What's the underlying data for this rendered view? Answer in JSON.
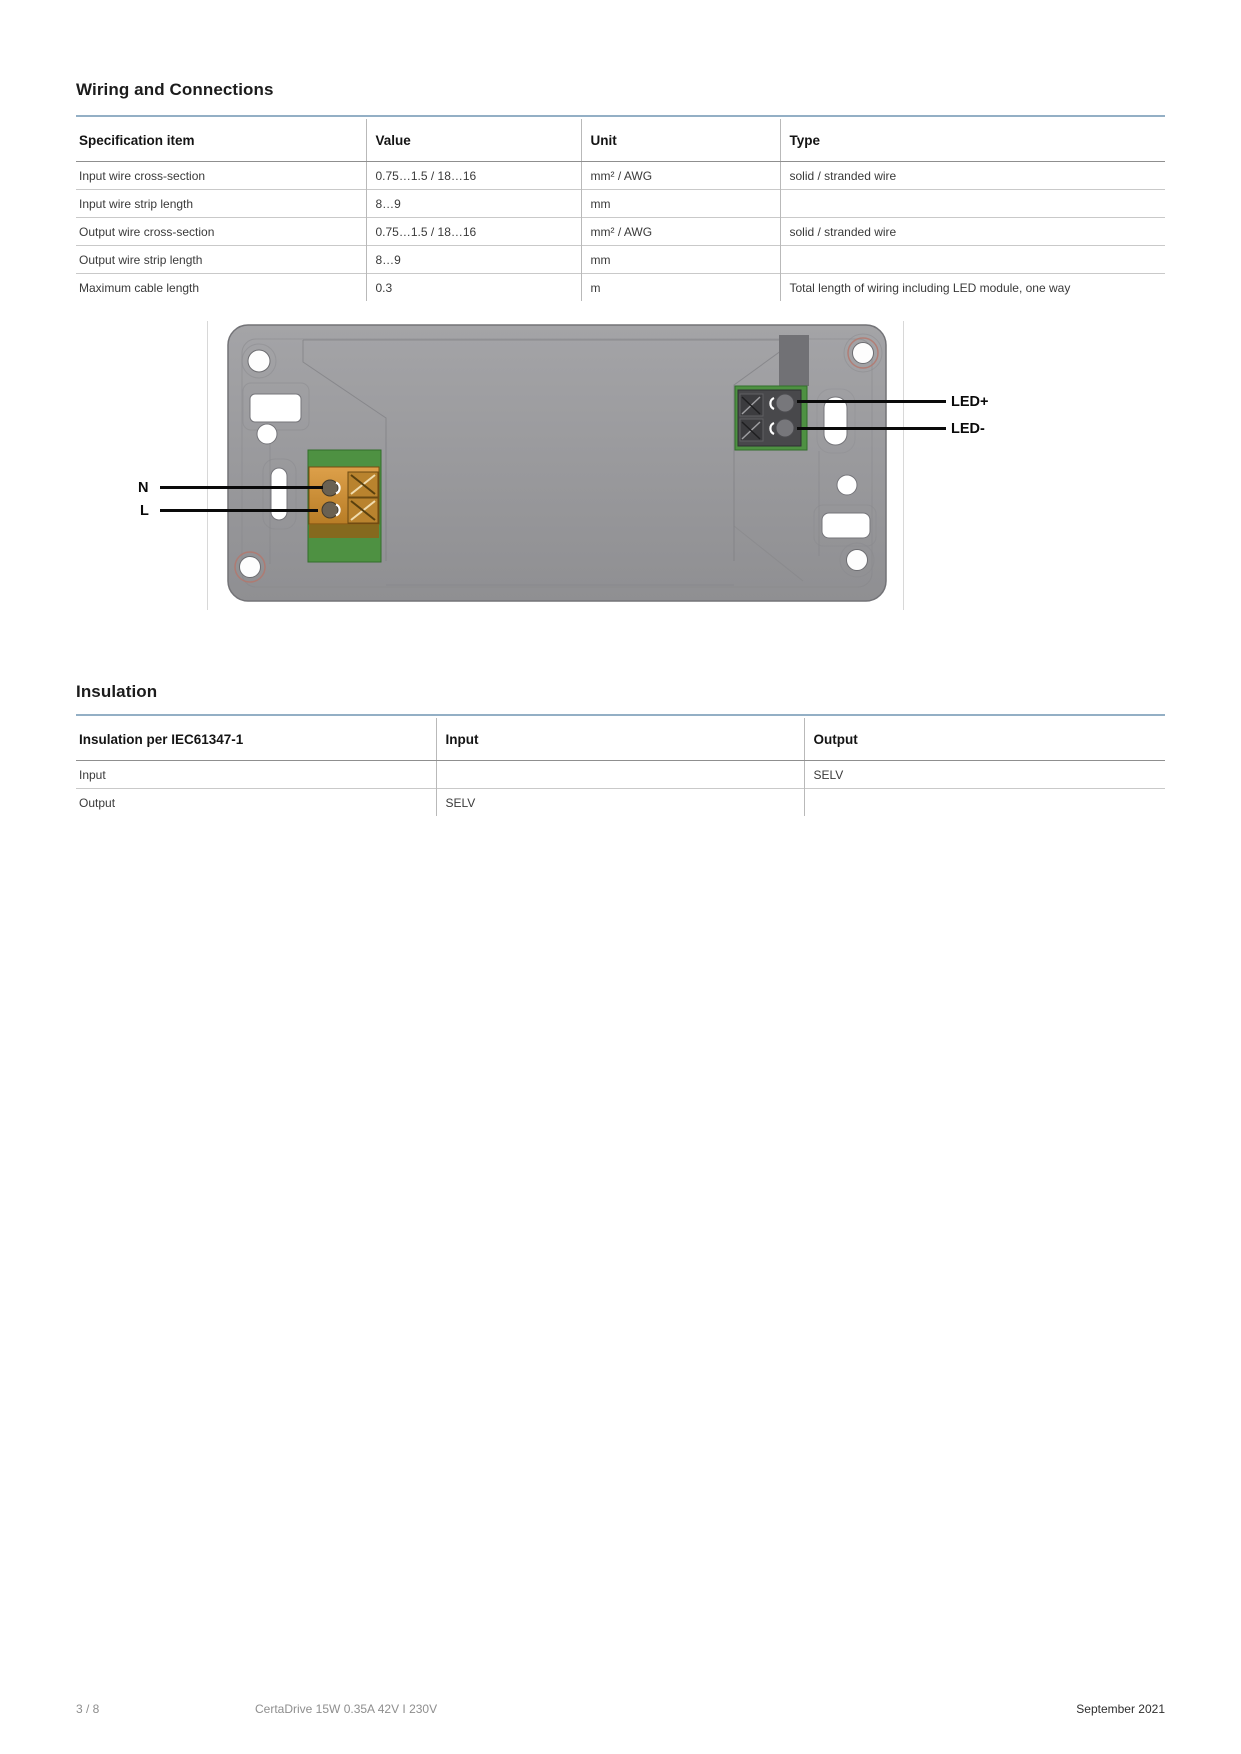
{
  "wiring": {
    "heading": "Wiring and Connections",
    "table": {
      "headers": [
        "Specification item",
        "Value",
        "Unit",
        "Type"
      ],
      "rows": [
        [
          "Input wire cross-section",
          "0.75…1.5 / 18…16",
          "mm² / AWG",
          "solid / stranded wire"
        ],
        [
          "Input wire strip length",
          "8…9",
          "mm",
          ""
        ],
        [
          "Output wire cross-section",
          "0.75…1.5 / 18…16",
          "mm² / AWG",
          "solid / stranded wire"
        ],
        [
          "Output wire strip length",
          "8…9",
          "mm",
          ""
        ],
        [
          "Maximum cable length",
          "0.3",
          "m",
          "Total length of wiring including LED module, one way"
        ]
      ]
    }
  },
  "figure": {
    "labels": {
      "led_plus": "LED+",
      "led_minus": "LED-",
      "neutral": "N",
      "line": "L"
    }
  },
  "insulation": {
    "heading": "Insulation",
    "table": {
      "headers": [
        "Insulation per IEC61347-1",
        "Input",
        "Output"
      ],
      "rows": [
        [
          "Input",
          "",
          "SELV"
        ],
        [
          "Output",
          "SELV",
          ""
        ]
      ]
    }
  },
  "footer": {
    "page_number": "3 / 8",
    "product": "CertaDrive 15W 0.35A 42V I 230V",
    "date": "September 2021"
  },
  "colors": {
    "section_rule_blue": "#93afc5",
    "pcb_green": "#4e9142",
    "input_terminal_orange": "#c8872f",
    "output_terminal_dark": "#48484b",
    "device_body_gray": "#9a9a9d",
    "label_black": "#0a0a0a"
  }
}
